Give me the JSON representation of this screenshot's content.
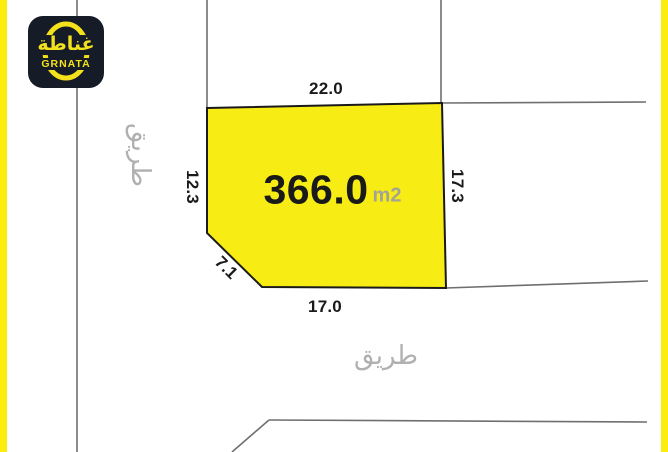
{
  "colors": {
    "plot_fill": "#F7EC13",
    "plot_stroke": "#1A1A1A",
    "line_gray": "#6F6F6F",
    "label_black": "#1A1A1A",
    "muted_gray": "#B1B0B0",
    "unit_gray": "#A3A396",
    "stripe_yellow": "#FBEE0C",
    "logo_bg": "#151C28",
    "logo_yellow": "#F3E11C"
  },
  "logo": {
    "arabic": "غناطة",
    "latin": "GRNATA"
  },
  "plot": {
    "area_value": "366.0",
    "area_unit": "m2",
    "dimensions": {
      "top": "22.0",
      "left": "12.3",
      "diagonal": "7.1",
      "bottom": "17.0",
      "right": "17.3"
    }
  },
  "roads": {
    "left": "طريق",
    "bottom": "طريق"
  }
}
